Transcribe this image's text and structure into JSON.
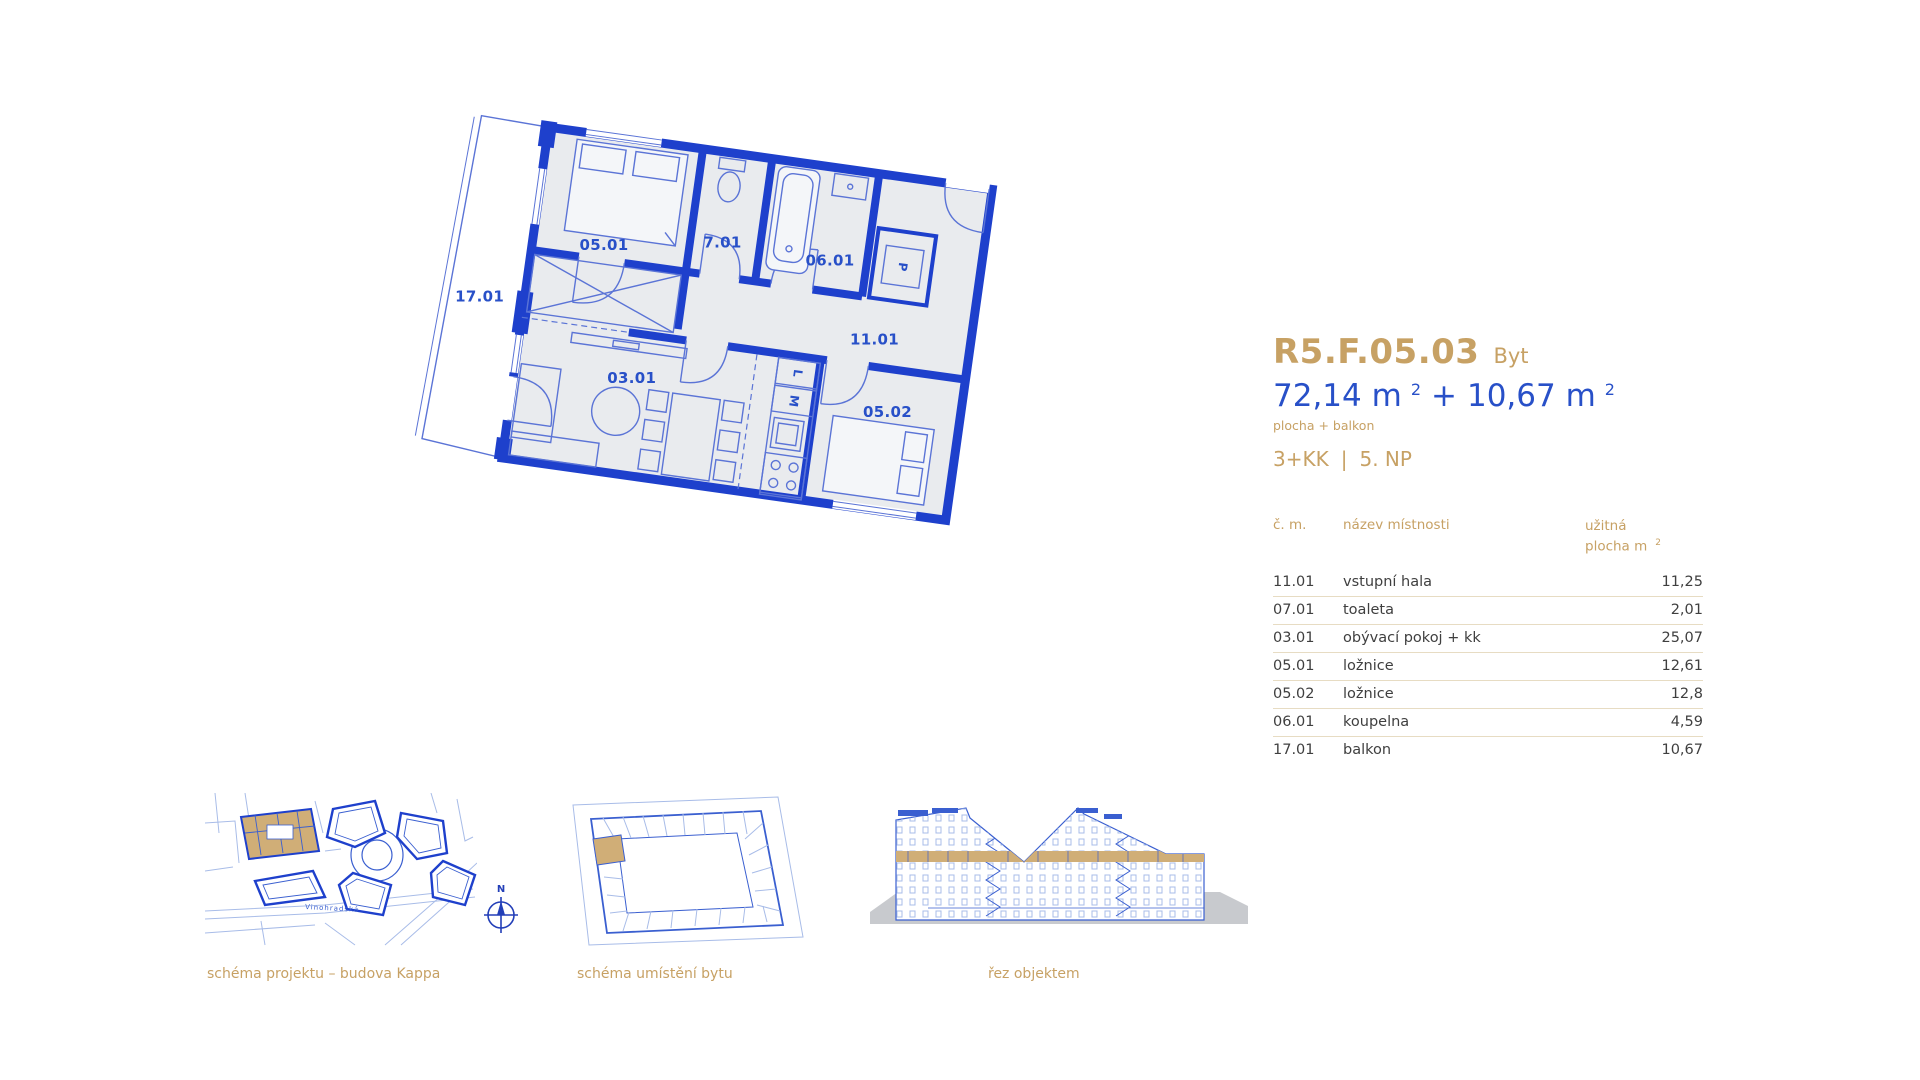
{
  "colors": {
    "gold": "#C7A164",
    "blue": "#2850C8",
    "wall_blue": "#1E40CC",
    "thin_blue": "#5B74D6",
    "plan_fill": "#E9EBEE",
    "table_text": "#3F3F3F",
    "divider": "#E7DCC3",
    "tan_highlight": "#D0AE77",
    "light_blue": "#A8BCE8",
    "ground_gray": "#C8CACE"
  },
  "unit": {
    "code": "R5.F.05.03",
    "type_label": "Byt",
    "area_main": "72,14 m",
    "area_main_sup": "2",
    "area_plus": "+",
    "area_balcony": "10,67 m",
    "area_balcony_sup": "2",
    "area_note": "plocha + balkon",
    "disposition": "3+KK",
    "separator": "|",
    "floor": "5. NP"
  },
  "table": {
    "header": {
      "col1": "č. m.",
      "col2": "název místnosti",
      "col3_line1": "užitná",
      "col3_line2": "plocha m",
      "col3_sup": "2"
    },
    "rows": [
      {
        "id": "11.01",
        "name": "vstupní hala",
        "area": "11,25"
      },
      {
        "id": "07.01",
        "name": "toaleta",
        "area": "2,01"
      },
      {
        "id": "03.01",
        "name": "obývací pokoj + kk",
        "area": "25,07"
      },
      {
        "id": "05.01",
        "name": "ložnice",
        "area": "12,61"
      },
      {
        "id": "05.02",
        "name": "ložnice",
        "area": "12,8"
      },
      {
        "id": "06.01",
        "name": "koupelna",
        "area": "4,59"
      },
      {
        "id": "17.01",
        "name": "balkon",
        "area": "10,67"
      }
    ]
  },
  "plan": {
    "rooms": [
      {
        "label": "05.01"
      },
      {
        "label": "7.01"
      },
      {
        "label": "06.01"
      },
      {
        "label": "11.01"
      },
      {
        "label": "17.01"
      },
      {
        "label": "03.01"
      },
      {
        "label": "05.02"
      }
    ],
    "tags": {
      "pantry": "P",
      "washer": "M",
      "dryer": "L"
    }
  },
  "schematics": {
    "site": {
      "caption": "schéma projektu – budova Kappa",
      "street": "Vinohradská",
      "compass": "N"
    },
    "location": {
      "caption": "schéma umístění bytu"
    },
    "section": {
      "caption": "řez objektem"
    }
  }
}
